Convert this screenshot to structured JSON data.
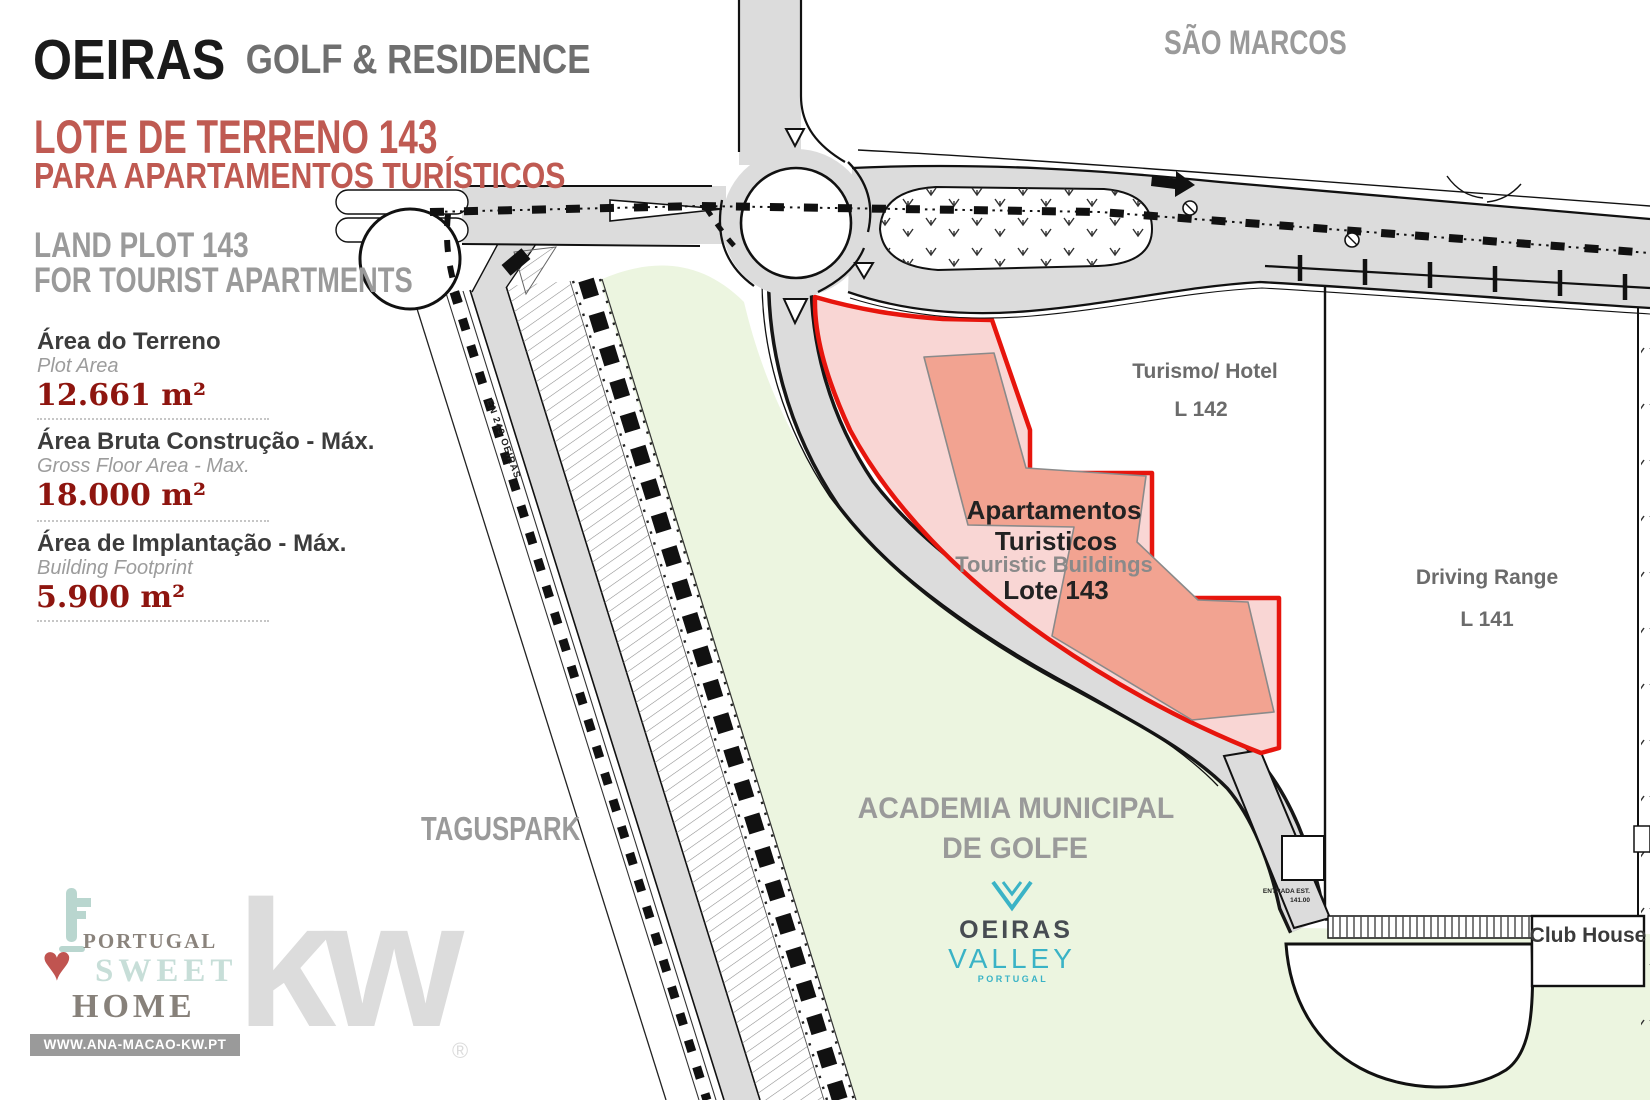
{
  "header": {
    "brand": "OEIRAS",
    "brand_suffix": "GOLF & RESIDENCE",
    "title_pt_line1": "LOTE DE TERRENO 143",
    "title_pt_line2": "PARA APARTAMENTOS TURÍSTICOS",
    "title_en_line1": "LAND PLOT 143",
    "title_en_line2": "FOR TOURIST APARTMENTS"
  },
  "stats": [
    {
      "label_pt": "Área do Terreno",
      "label_en": "Plot Area",
      "value": "12.661 m²"
    },
    {
      "label_pt": "Área Bruta Construção - Máx.",
      "label_en": "Gross Floor Area - Max.",
      "value": "18.000 m²"
    },
    {
      "label_pt": "Área de Implantação - Máx.",
      "label_en": "Building Footprint",
      "value": "5.900 m²"
    }
  ],
  "map": {
    "area_sao_marcos": "SÃO MARCOS",
    "area_taguspark": "TAGUSPARK",
    "plot143_line1": "Apartamentos",
    "plot143_line2": "Turisticos",
    "plot143_line3": "Touristic Buildings",
    "plot143_line4": "Lote 143",
    "plot142_line1": "Turismo/ Hotel",
    "plot142_line2": "L 142",
    "plot141_line1": "Driving Range",
    "plot141_line2": "L 141",
    "club_house": "Club House",
    "academia_line1": "ACADEMIA MUNICIPAL",
    "academia_line2": "DE GOLFE",
    "road_label": "EN 249 OEIRAS",
    "entrance_line1": "ENTRADA EST.",
    "entrance_line2": "141.00"
  },
  "logos": {
    "oeiras_valley": {
      "name": "OEIRAS",
      "sub": "VALLEY",
      "country": "PORTUGAL"
    },
    "psh": {
      "line1": "PORTUGAL",
      "line2": "SWEET",
      "line3": "HOME",
      "heart_icon": "♥",
      "url": "WWW.ANA-MACAO-KW.PT"
    },
    "kw": {
      "text": "kw",
      "reg": "®"
    }
  },
  "colors": {
    "accent_red": "#e7150d",
    "plot_fill": "#f9d6d4",
    "building_fill": "#f2a391",
    "value_red": "#8e150f",
    "title_red": "#bf5a52",
    "teal": "#3ab3c6",
    "road_gray": "#dcdcdc",
    "green": "#ecf5e0"
  }
}
